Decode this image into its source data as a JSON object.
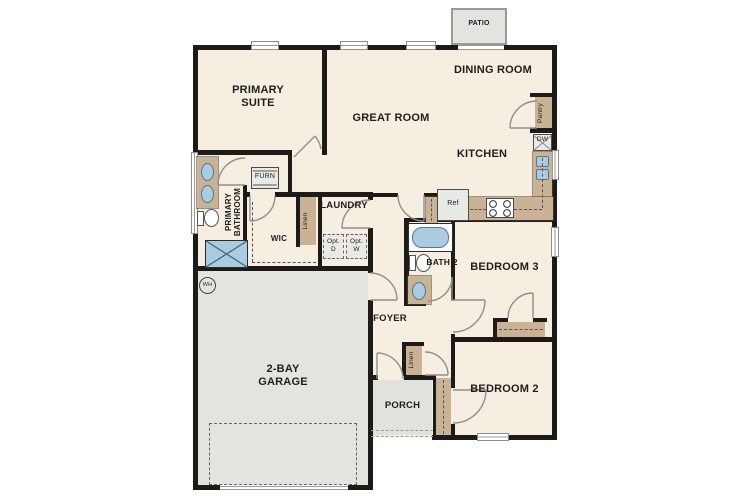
{
  "meta": {
    "type": "residential-floor-plan"
  },
  "colors": {
    "wall": "#1d1b17",
    "floor": "#f6eee0",
    "garage_floor": "#e4e4df",
    "casework_tan": "#c9b394",
    "fixture_blue": "#abcbe0",
    "door_swing": "#8f8f8f",
    "label": "#1e1e1e"
  },
  "rooms": {
    "patio": "PATIO",
    "dining": "DINING ROOM",
    "primary_suite": "PRIMARY SUITE",
    "great_room": "GREAT ROOM",
    "kitchen": "KITCHEN",
    "primary_bath": "PRIMARY BATHROOM",
    "wic": "WIC",
    "laundry": "LAUNDRY",
    "foyer": "FOYER",
    "bath2": "BATH 2",
    "bedroom3": "BEDROOM 3",
    "bedroom2": "BEDROOM 2",
    "garage": "2-BAY GARAGE",
    "porch": "PORCH"
  },
  "fixtures": {
    "pantry": "Pantry",
    "dishwasher": "DW",
    "refrigerator": "Ref",
    "furnace": "FURN",
    "linen_hall": "Linen",
    "linen_foyer": "Linen",
    "optional_dryer": "Opt. D",
    "optional_washer": "Opt. W",
    "water_heater": "WH"
  }
}
